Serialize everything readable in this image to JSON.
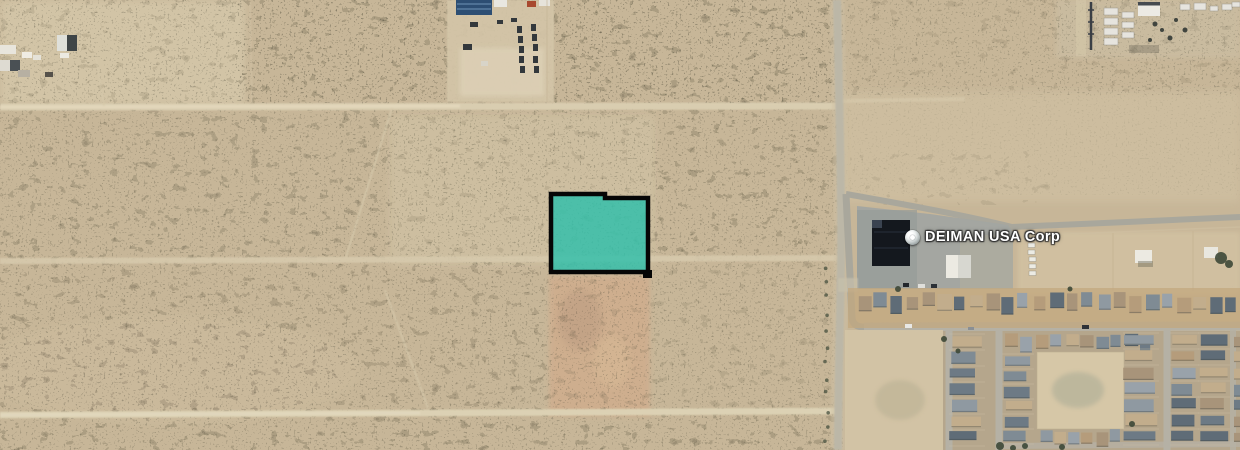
{
  "map": {
    "imagery": "satellite",
    "poi": {
      "icon": "place-marker-icon",
      "label": "DEIMAN USA Corp"
    },
    "parcel": {
      "fill": "#2fc0ab",
      "stroke": "#060606",
      "opacity": "0.82"
    },
    "palette": {
      "sand": "#c7b698",
      "sand_light": "#d8cbae",
      "cleared_dirt": "#cfae8e",
      "scrub": "#474433",
      "dirt_road": "#dbcfb2",
      "paved_road": "#b2afa3",
      "parking_lot": "#a2a5a1",
      "dark_roof": "#14181e",
      "white_roof": "#eceae2",
      "blue_roof": "#2d4e73",
      "tree": "#3d4837",
      "house_roofs": [
        "#6d7a85",
        "#7f8b94",
        "#5f6c77",
        "#8f99a1",
        "#b59c7b",
        "#c2ad8c",
        "#a8947a",
        "#99a2aa"
      ]
    }
  }
}
